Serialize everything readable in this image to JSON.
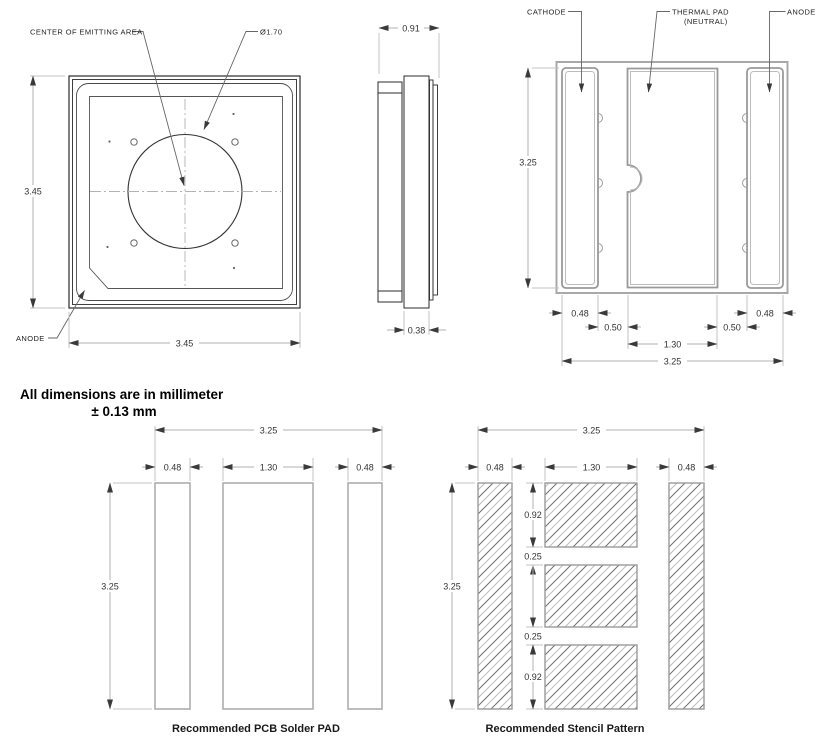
{
  "front_view": {
    "label_center_of_emitting_area": "CENTER OF EMITTING AREA",
    "label_diameter": "Ø1.70",
    "label_anode": "ANODE",
    "dim_height": "3.45",
    "dim_width": "3.45"
  },
  "side_view": {
    "dim_width": "0.91",
    "dim_standoff": "0.38"
  },
  "bottom_view": {
    "label_cathode": "CATHODE",
    "label_thermal_line1": "THERMAL PAD",
    "label_thermal_line2": "(NEUTRAL)",
    "label_anode": "ANODE",
    "dim_height": "3.25",
    "dim_cathode_width": "0.48",
    "dim_gap_left": "0.50",
    "dim_thermal_width": "1.30",
    "dim_gap_right": "0.50",
    "dim_anode_width": "0.48",
    "dim_width": "3.25"
  },
  "note": {
    "line1": "All dimensions are in millimeter",
    "line2": "± 0.13 mm"
  },
  "pcb_pad_view": {
    "caption": "Recommended PCB Solder PAD",
    "dim_width": "3.25",
    "dim_left_pad": "0.48",
    "dim_center_pad": "1.30",
    "dim_right_pad": "0.48",
    "dim_height": "3.25"
  },
  "stencil_view": {
    "caption": "Recommended Stencil Pattern",
    "dim_width": "3.25",
    "dim_left_pad": "0.48",
    "dim_center_pad": "1.30",
    "dim_right_pad": "0.48",
    "dim_height": "3.25",
    "dim_segment_top": "0.92",
    "dim_gap_top": "0.25",
    "dim_gap_bottom": "0.25",
    "dim_segment_bottom": "0.92"
  }
}
